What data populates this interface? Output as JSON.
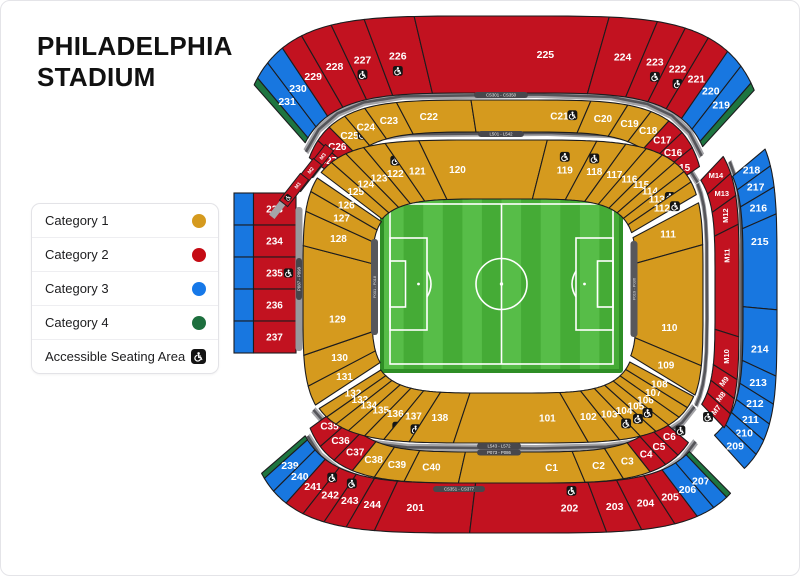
{
  "title": {
    "line1": "PHILADELPHIA",
    "line2": "STADIUM"
  },
  "legend": {
    "items": [
      {
        "label": "Category 1",
        "type": "dot",
        "color": "#D59A1E"
      },
      {
        "label": "Category 2",
        "type": "dot",
        "color": "#C50B14"
      },
      {
        "label": "Category 3",
        "type": "dot",
        "color": "#1678E8"
      },
      {
        "label": "Category 4",
        "type": "dot",
        "color": "#1D6F3E"
      },
      {
        "label": "Accessible Seating Area",
        "type": "accessible"
      }
    ]
  },
  "colors": {
    "cat1": "#D59A1E",
    "cat2": "#C21220",
    "cat3": "#1877E0",
    "cat4": "#1E7540",
    "walkway": "#A4A4A8",
    "walkway_dark": "#55555A",
    "outline": "#1c1c1e",
    "field_light": "#57BD48",
    "field_dark": "#45AB36",
    "field_frame": "#2F8E26"
  },
  "map": {
    "walkway_labels": {
      "top_outer": "CS301 - CS350",
      "top_inner": "L501 - L542",
      "bottom_inner_a": "L543 - L572",
      "bottom_inner_b": "P073 - P086",
      "bottom_outer": "CS351 - CS377",
      "left_bar": "P087 - P098",
      "pitch_left": "P001 - P018",
      "pitch_right": "P019 - P036"
    },
    "corner_strips": [
      "M3",
      "M2",
      "M1"
    ],
    "left_column": {
      "rows": [
        {
          "label": "233",
          "cat": 2
        },
        {
          "label": "234",
          "cat": 2
        },
        {
          "label": "235",
          "cat": 2,
          "acc": true
        },
        {
          "label": "236",
          "cat": 2
        },
        {
          "label": "237",
          "cat": 2
        }
      ]
    },
    "bands": [
      {
        "id": "outer-top",
        "sections": [
          {
            "label": "",
            "cat": 4,
            "w": 0.32
          },
          {
            "label": "231",
            "cat": 3,
            "w": 0.8
          },
          {
            "label": "230",
            "cat": 3,
            "w": 0.95
          },
          {
            "label": "229",
            "cat": 2,
            "w": 1.0
          },
          {
            "label": "228",
            "cat": 2,
            "w": 1.2
          },
          {
            "label": "227",
            "cat": 2,
            "w": 1.0,
            "acc": true
          },
          {
            "label": "226",
            "cat": 2,
            "w": 1.0,
            "acc": true
          },
          {
            "label": "225",
            "cat": 2,
            "w": 1.45
          },
          {
            "label": "224",
            "cat": 2,
            "w": 1.15
          },
          {
            "label": "223",
            "cat": 2,
            "w": 0.95,
            "acc": true
          },
          {
            "label": "222",
            "cat": 2,
            "w": 1.0,
            "acc": true
          },
          {
            "label": "221",
            "cat": 2,
            "w": 1.05
          },
          {
            "label": "220",
            "cat": 3,
            "w": 0.9
          },
          {
            "label": "219",
            "cat": 3,
            "w": 0.85
          },
          {
            "label": "",
            "cat": 4,
            "w": 0.32
          }
        ]
      },
      {
        "id": "outer-right",
        "sections": [
          {
            "label": "218",
            "cat": 3,
            "w": 0.95
          },
          {
            "label": "217",
            "cat": 3,
            "w": 0.95
          },
          {
            "label": "216",
            "cat": 3,
            "w": 0.9
          },
          {
            "label": "215",
            "cat": 3,
            "w": 1.0
          },
          {
            "label": "214",
            "cat": 3,
            "w": 1.05
          },
          {
            "label": "213",
            "cat": 3,
            "w": 1.0
          },
          {
            "label": "212",
            "cat": 3,
            "w": 0.95
          },
          {
            "label": "211",
            "cat": 3,
            "w": 0.95
          },
          {
            "label": "210",
            "cat": 3,
            "w": 1.0
          },
          {
            "label": "209",
            "cat": 3,
            "w": 1.2
          }
        ]
      },
      {
        "id": "outer-bottom",
        "sections": [
          {
            "label": "",
            "cat": 4,
            "w": 0.3
          },
          {
            "label": "239",
            "cat": 3,
            "w": 0.85
          },
          {
            "label": "240",
            "cat": 3,
            "w": 0.95
          },
          {
            "label": "241",
            "cat": 2,
            "w": 1.05
          },
          {
            "label": "242",
            "cat": 2,
            "w": 1.05,
            "acc": true
          },
          {
            "label": "243",
            "cat": 2,
            "w": 0.9,
            "acc": true
          },
          {
            "label": "244",
            "cat": 2,
            "w": 0.9
          },
          {
            "label": "201",
            "cat": 2,
            "w": 1.5
          },
          {
            "label": "202",
            "cat": 2,
            "w": 1.05,
            "acc": true
          },
          {
            "label": "203",
            "cat": 2,
            "w": 0.9
          },
          {
            "label": "204",
            "cat": 2,
            "w": 1.2
          },
          {
            "label": "205",
            "cat": 2,
            "w": 1.05
          },
          {
            "label": "206",
            "cat": 3,
            "w": 0.95
          },
          {
            "label": "207",
            "cat": 3,
            "w": 0.9
          },
          {
            "label": "",
            "cat": 4,
            "w": 0.3
          }
        ]
      },
      {
        "id": "c-top",
        "sections": [
          {
            "label": "C27",
            "cat": 2,
            "w": 0.95
          },
          {
            "label": "C26",
            "cat": 2,
            "w": 0.95
          },
          {
            "label": "C25",
            "cat": 1,
            "w": 1.0,
            "acc": true
          },
          {
            "label": "C24",
            "cat": 1,
            "w": 1.0
          },
          {
            "label": "C23",
            "cat": 1,
            "w": 1.15
          },
          {
            "label": "C22",
            "cat": 1,
            "w": 1.3
          },
          {
            "label": "C21",
            "cat": 1,
            "w": 1.0,
            "acc": true
          },
          {
            "label": "C20",
            "cat": 1,
            "w": 1.1
          },
          {
            "label": "C19",
            "cat": 1,
            "w": 1.0
          },
          {
            "label": "C18",
            "cat": 1,
            "w": 1.0
          },
          {
            "label": "C17",
            "cat": 2,
            "w": 0.95
          },
          {
            "label": "C16",
            "cat": 2,
            "w": 0.95
          },
          {
            "label": "C15",
            "cat": 2,
            "w": 0.95
          }
        ]
      },
      {
        "id": "c-bottom",
        "sections": [
          {
            "label": "C35",
            "cat": 2,
            "w": 1.15
          },
          {
            "label": "C36",
            "cat": 2,
            "w": 1.15
          },
          {
            "label": "C37",
            "cat": 2,
            "w": 1.15
          },
          {
            "label": "C38",
            "cat": 1,
            "w": 1.05
          },
          {
            "label": "C39",
            "cat": 1,
            "w": 1.05
          },
          {
            "label": "C40",
            "cat": 1,
            "w": 1.05
          },
          {
            "label": "C1",
            "cat": 1,
            "w": 1.05
          },
          {
            "label": "C2",
            "cat": 1,
            "w": 1.15
          },
          {
            "label": "C3",
            "cat": 1,
            "w": 1.2
          },
          {
            "label": "C4",
            "cat": 2,
            "w": 0.9,
            "acc": true
          },
          {
            "label": "C5",
            "cat": 2,
            "w": 0.9
          },
          {
            "label": "C6",
            "cat": 2,
            "w": 0.95,
            "acc": true
          }
        ]
      },
      {
        "id": "m-right",
        "sections": [
          {
            "label": "M14",
            "cat": 2,
            "w": 1.1
          },
          {
            "label": "M13",
            "cat": 2,
            "w": 1.1
          },
          {
            "label": "M12",
            "cat": 2,
            "w": 1.0,
            "rot": -90
          },
          {
            "label": "M11",
            "cat": 2,
            "w": 1.15,
            "rot": -90
          },
          {
            "label": "M10",
            "cat": 2,
            "w": 1.1,
            "rot": -90
          },
          {
            "label": "M9",
            "cat": 2,
            "w": 0.8,
            "rot": -52
          },
          {
            "label": "M8",
            "cat": 2,
            "w": 0.8,
            "rot": -52
          },
          {
            "label": "M7",
            "cat": 2,
            "w": 0.9,
            "rot": -52,
            "acc": true
          }
        ]
      },
      {
        "id": "g-left",
        "sections": [
          {
            "label": "131",
            "cat": 1,
            "w": 1.15
          },
          {
            "label": "130",
            "cat": 1,
            "w": 1.25
          },
          {
            "label": "129",
            "cat": 1,
            "w": 1.3
          },
          {
            "label": "128",
            "cat": 1,
            "w": 1.1
          },
          {
            "label": "127",
            "cat": 1,
            "w": 1.0
          },
          {
            "label": "126",
            "cat": 1,
            "w": 0.9
          }
        ]
      },
      {
        "id": "g-top",
        "sections": [
          {
            "label": "125",
            "cat": 1,
            "w": 1.0
          },
          {
            "label": "124",
            "cat": 1,
            "w": 1.1
          },
          {
            "label": "123",
            "cat": 1,
            "w": 1.05
          },
          {
            "label": "122",
            "cat": 1,
            "w": 1.0,
            "acc": true
          },
          {
            "label": "121",
            "cat": 1,
            "w": 1.1
          },
          {
            "label": "120",
            "cat": 1,
            "w": 1.2
          },
          {
            "label": "119",
            "cat": 1,
            "w": 1.0,
            "acc": true
          },
          {
            "label": "118",
            "cat": 1,
            "w": 1.05,
            "acc": true
          },
          {
            "label": "117",
            "cat": 1,
            "w": 1.0
          },
          {
            "label": "116",
            "cat": 1,
            "w": 1.0
          },
          {
            "label": "115",
            "cat": 1,
            "w": 0.95
          },
          {
            "label": "114",
            "cat": 1,
            "w": 0.9
          },
          {
            "label": "113",
            "cat": 1,
            "w": 0.85,
            "acc": true,
            "ix": 13,
            "iy": -2
          },
          {
            "label": "112",
            "cat": 1,
            "w": 0.85,
            "acc": true,
            "ix": 13,
            "iy": -2
          }
        ]
      },
      {
        "id": "g-right",
        "sections": [
          {
            "label": "111",
            "cat": 1,
            "w": 1.05
          },
          {
            "label": "110",
            "cat": 1,
            "w": 1.2
          },
          {
            "label": "109",
            "cat": 1,
            "w": 1.0
          }
        ]
      },
      {
        "id": "g-bottom",
        "sections": [
          {
            "label": "132",
            "cat": 1,
            "w": 0.9
          },
          {
            "label": "133",
            "cat": 1,
            "w": 0.9
          },
          {
            "label": "134",
            "cat": 1,
            "w": 1.0
          },
          {
            "label": "135",
            "cat": 1,
            "w": 1.05
          },
          {
            "label": "136",
            "cat": 1,
            "w": 1.0,
            "acc": true
          },
          {
            "label": "137",
            "cat": 1,
            "w": 1.0,
            "acc": true
          },
          {
            "label": "138",
            "cat": 1,
            "w": 1.05
          },
          {
            "label": "101",
            "cat": 1,
            "w": 1.45
          },
          {
            "label": "102",
            "cat": 1,
            "w": 1.15
          },
          {
            "label": "103",
            "cat": 1,
            "w": 1.05
          },
          {
            "label": "104",
            "cat": 1,
            "w": 1.0,
            "acc": true
          },
          {
            "label": "105",
            "cat": 1,
            "w": 1.0,
            "acc": true
          },
          {
            "label": "106",
            "cat": 1,
            "w": 1.0,
            "acc": true
          },
          {
            "label": "107",
            "cat": 1,
            "w": 1.0
          },
          {
            "label": "108",
            "cat": 1,
            "w": 0.95
          }
        ]
      }
    ]
  }
}
